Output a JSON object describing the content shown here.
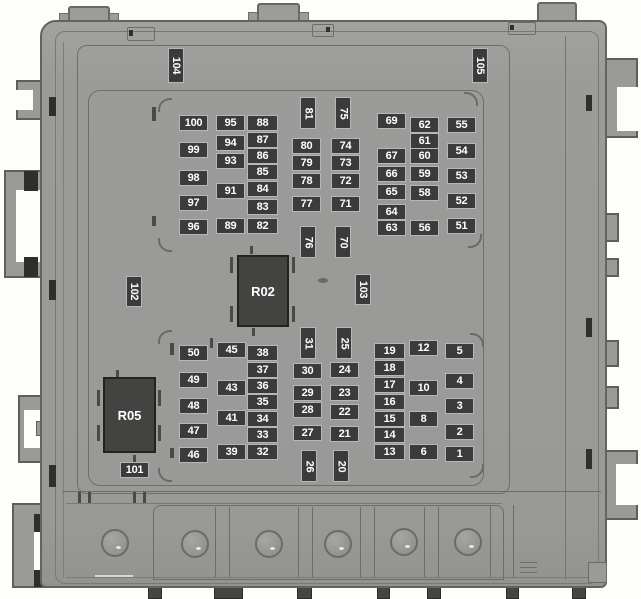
{
  "diagram": {
    "type": "fuse-box-top-view",
    "relay_count": 2,
    "fuse_label_count": 90,
    "sticker_labels": [
      "101",
      "102",
      "103",
      "104",
      "105"
    ],
    "connector_hole_count": 6,
    "colors": {
      "background": "#fdfdfc",
      "body": "#9c9c9a",
      "outline": "#636361",
      "label_background": "#3b3b3b",
      "label_text": "#ffffff",
      "relay_background": "#434341",
      "cutout": "#ffffff"
    }
  },
  "relays": [
    {
      "label": "R02",
      "x": 237,
      "y": 255,
      "w": 52,
      "h": 72
    },
    {
      "label": "R05",
      "x": 103,
      "y": 377,
      "w": 53,
      "h": 76
    }
  ],
  "labels": [
    {
      "t": "100",
      "x": 179,
      "y": 115
    },
    {
      "t": "99",
      "x": 179,
      "y": 142
    },
    {
      "t": "98",
      "x": 179,
      "y": 170
    },
    {
      "t": "97",
      "x": 179,
      "y": 195
    },
    {
      "t": "96",
      "x": 179,
      "y": 219
    },
    {
      "t": "95",
      "x": 216,
      "y": 115
    },
    {
      "t": "94",
      "x": 216,
      "y": 135
    },
    {
      "t": "93",
      "x": 216,
      "y": 153
    },
    {
      "t": "91",
      "x": 216,
      "y": 183
    },
    {
      "t": "89",
      "x": 216,
      "y": 218
    },
    {
      "t": "88",
      "x": 247,
      "y": 115,
      "w": 31
    },
    {
      "t": "87",
      "x": 247,
      "y": 132,
      "w": 31
    },
    {
      "t": "86",
      "x": 247,
      "y": 148,
      "w": 31
    },
    {
      "t": "85",
      "x": 247,
      "y": 164,
      "w": 31
    },
    {
      "t": "84",
      "x": 247,
      "y": 181,
      "w": 31
    },
    {
      "t": "83",
      "x": 247,
      "y": 199,
      "w": 31
    },
    {
      "t": "82",
      "x": 247,
      "y": 218,
      "w": 31
    },
    {
      "t": "81",
      "x": 300,
      "y": 97,
      "v": true
    },
    {
      "t": "80",
      "x": 292,
      "y": 138
    },
    {
      "t": "79",
      "x": 292,
      "y": 155
    },
    {
      "t": "78",
      "x": 292,
      "y": 173
    },
    {
      "t": "77",
      "x": 292,
      "y": 196
    },
    {
      "t": "76",
      "x": 300,
      "y": 226,
      "v": true
    },
    {
      "t": "75",
      "x": 335,
      "y": 97,
      "v": true
    },
    {
      "t": "74",
      "x": 331,
      "y": 138
    },
    {
      "t": "73",
      "x": 331,
      "y": 155
    },
    {
      "t": "72",
      "x": 331,
      "y": 173
    },
    {
      "t": "71",
      "x": 331,
      "y": 196
    },
    {
      "t": "70",
      "x": 335,
      "y": 226,
      "v": true
    },
    {
      "t": "69",
      "x": 377,
      "y": 113
    },
    {
      "t": "67",
      "x": 377,
      "y": 148
    },
    {
      "t": "66",
      "x": 377,
      "y": 166
    },
    {
      "t": "65",
      "x": 377,
      "y": 184
    },
    {
      "t": "64",
      "x": 377,
      "y": 204
    },
    {
      "t": "63",
      "x": 377,
      "y": 220
    },
    {
      "t": "62",
      "x": 410,
      "y": 117
    },
    {
      "t": "61",
      "x": 410,
      "y": 133
    },
    {
      "t": "60",
      "x": 410,
      "y": 148
    },
    {
      "t": "59",
      "x": 410,
      "y": 166
    },
    {
      "t": "58",
      "x": 410,
      "y": 185
    },
    {
      "t": "56",
      "x": 410,
      "y": 220
    },
    {
      "t": "55",
      "x": 447,
      "y": 117
    },
    {
      "t": "54",
      "x": 447,
      "y": 143
    },
    {
      "t": "53",
      "x": 447,
      "y": 168
    },
    {
      "t": "52",
      "x": 447,
      "y": 193
    },
    {
      "t": "51",
      "x": 447,
      "y": 218
    },
    {
      "t": "50",
      "x": 179,
      "y": 345
    },
    {
      "t": "49",
      "x": 179,
      "y": 372
    },
    {
      "t": "48",
      "x": 179,
      "y": 398
    },
    {
      "t": "47",
      "x": 179,
      "y": 423
    },
    {
      "t": "46",
      "x": 179,
      "y": 447
    },
    {
      "t": "45",
      "x": 217,
      "y": 342
    },
    {
      "t": "43",
      "x": 217,
      "y": 380
    },
    {
      "t": "41",
      "x": 217,
      "y": 410
    },
    {
      "t": "39",
      "x": 217,
      "y": 444
    },
    {
      "t": "38",
      "x": 247,
      "y": 345,
      "w": 31
    },
    {
      "t": "37",
      "x": 247,
      "y": 362,
      "w": 31
    },
    {
      "t": "36",
      "x": 247,
      "y": 378,
      "w": 31
    },
    {
      "t": "35",
      "x": 247,
      "y": 394,
      "w": 31
    },
    {
      "t": "34",
      "x": 247,
      "y": 411,
      "w": 31
    },
    {
      "t": "33",
      "x": 247,
      "y": 427,
      "w": 31
    },
    {
      "t": "32",
      "x": 247,
      "y": 444,
      "w": 31
    },
    {
      "t": "31",
      "x": 300,
      "y": 327,
      "v": true
    },
    {
      "t": "30",
      "x": 293,
      "y": 363
    },
    {
      "t": "29",
      "x": 293,
      "y": 385
    },
    {
      "t": "28",
      "x": 293,
      "y": 402
    },
    {
      "t": "27",
      "x": 293,
      "y": 425
    },
    {
      "t": "26",
      "x": 301,
      "y": 450,
      "v": true
    },
    {
      "t": "25",
      "x": 336,
      "y": 327,
      "v": true
    },
    {
      "t": "24",
      "x": 330,
      "y": 362
    },
    {
      "t": "23",
      "x": 330,
      "y": 385
    },
    {
      "t": "22",
      "x": 330,
      "y": 404
    },
    {
      "t": "21",
      "x": 330,
      "y": 426
    },
    {
      "t": "20",
      "x": 333,
      "y": 450,
      "v": true
    },
    {
      "t": "19",
      "x": 374,
      "y": 343,
      "w": 31
    },
    {
      "t": "18",
      "x": 374,
      "y": 360,
      "w": 31
    },
    {
      "t": "17",
      "x": 374,
      "y": 377,
      "w": 31
    },
    {
      "t": "16",
      "x": 374,
      "y": 394,
      "w": 31
    },
    {
      "t": "15",
      "x": 374,
      "y": 411,
      "w": 31
    },
    {
      "t": "14",
      "x": 374,
      "y": 427,
      "w": 31
    },
    {
      "t": "13",
      "x": 374,
      "y": 444,
      "w": 31
    },
    {
      "t": "12",
      "x": 409,
      "y": 340
    },
    {
      "t": "10",
      "x": 409,
      "y": 380
    },
    {
      "t": "8",
      "x": 409,
      "y": 411
    },
    {
      "t": "6",
      "x": 409,
      "y": 444
    },
    {
      "t": "5",
      "x": 445,
      "y": 343
    },
    {
      "t": "4",
      "x": 445,
      "y": 373
    },
    {
      "t": "3",
      "x": 445,
      "y": 398
    },
    {
      "t": "2",
      "x": 445,
      "y": 424
    },
    {
      "t": "1",
      "x": 445,
      "y": 446
    },
    {
      "t": "101",
      "x": 120,
      "y": 462
    },
    {
      "t": "102",
      "x": 126,
      "y": 276,
      "v": true,
      "h": 31
    },
    {
      "t": "103",
      "x": 355,
      "y": 274,
      "v": true,
      "h": 31
    },
    {
      "t": "104",
      "x": 168,
      "y": 48,
      "v": true,
      "h": 35
    },
    {
      "t": "105",
      "x": 472,
      "y": 48,
      "v": true,
      "h": 35
    }
  ]
}
